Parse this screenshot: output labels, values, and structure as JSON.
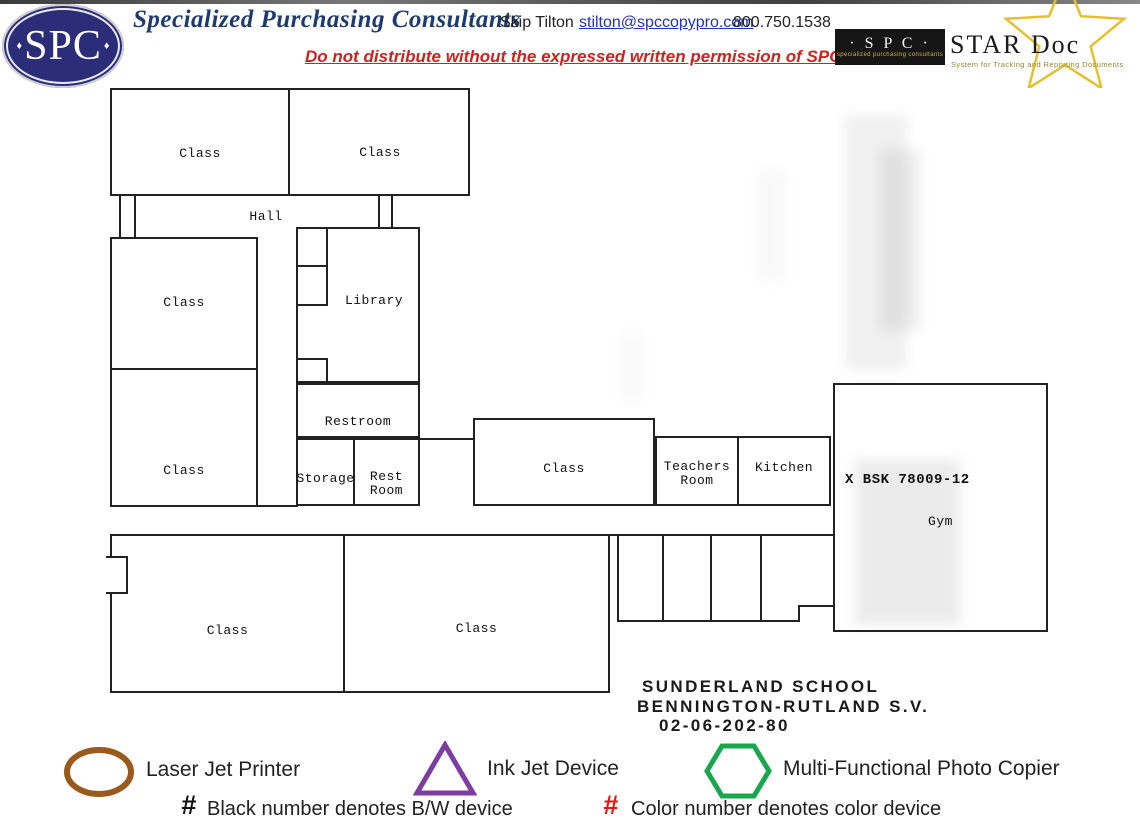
{
  "header": {
    "logo": {
      "diamond": "♦",
      "text": "SPC"
    },
    "company": "Specialized Purchasing Consultants",
    "contact_name": "Skip Tilton",
    "contact_email": "stilton@spccopypro.com",
    "contact_phone": "800.750.1538",
    "notice": "Do not distribute without the expressed written permission of SPC",
    "stardoc": {
      "spc": "· S P C ·",
      "spc_sub": "specialized purchasing consultants",
      "title": "STAR Doc",
      "tagline": "System for Tracking and Reporting Documents",
      "star_color": "#E4C02C"
    }
  },
  "plan": {
    "rooms": {
      "class_tl": "Class",
      "class_tr": "Class",
      "hall": "Hall",
      "class_ml_upper": "Class",
      "class_ml_lower": "Class",
      "library": "Library",
      "restroom": "Restroom",
      "storage": "Storage",
      "rest_line1": "Rest",
      "rest_line2": "Room",
      "class_center": "Class",
      "teachers_line1": "Teachers",
      "teachers_line2": "Room",
      "kitchen": "Kitchen",
      "gym_code": "X BSK 78009-12",
      "gym": "Gym",
      "class_bl": "Class",
      "class_bm": "Class"
    },
    "title_block": {
      "line1": "SUNDERLAND SCHOOL",
      "line2": "BENNINGTON-RUTLAND S.V.",
      "line3": "02-06-202-80"
    }
  },
  "legend": {
    "items": [
      {
        "shape": "ellipse",
        "color": "#9A5A1E",
        "label": "Laser Jet Printer"
      },
      {
        "shape": "triangle",
        "color": "#7B3DA0",
        "label": "Ink Jet Device"
      },
      {
        "shape": "hexagon",
        "color": "#19A74E",
        "label": "Multi-Functional Photo Copier"
      }
    ],
    "notes": [
      {
        "symbol": "#",
        "color": "#111111",
        "text": "Black number denotes B/W device"
      },
      {
        "symbol": "#",
        "color": "#EE1111",
        "text": "Color number denotes color device"
      }
    ]
  }
}
